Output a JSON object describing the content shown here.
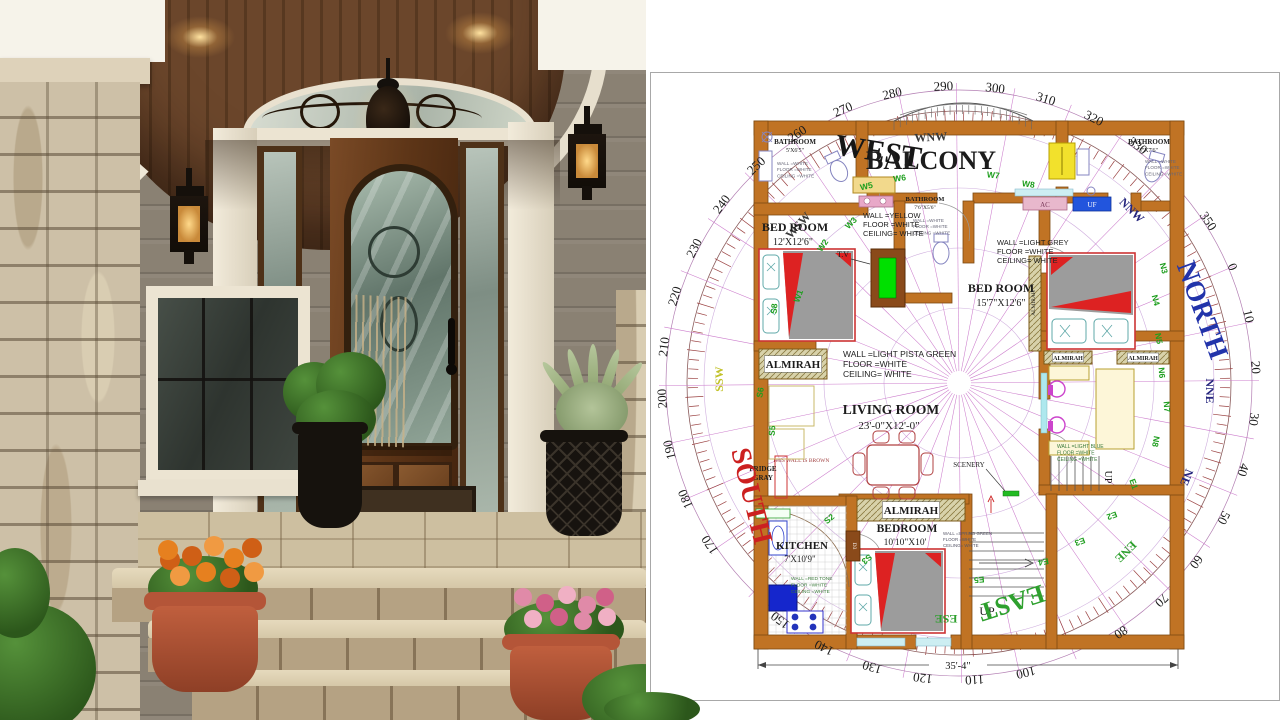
{
  "colors": {
    "wall": "#c07324",
    "wall_stroke": "#7c4a12",
    "radial": "#cc7ccc",
    "tick_ring": "#9a4040",
    "green_code": "#1e9e1e",
    "north": "#2233aa",
    "south": "#cc2020",
    "east": "#2ea02e",
    "west": "#161616"
  },
  "floor_plan": {
    "dimension_label": "35'-4\"",
    "compass": {
      "degrees": [
        0,
        10,
        20,
        30,
        40,
        50,
        60,
        70,
        80,
        100,
        110,
        120,
        130,
        140,
        150,
        170,
        180,
        190,
        200,
        210,
        220,
        230,
        240,
        250,
        260,
        270,
        280,
        290,
        300,
        310,
        320,
        330,
        350
      ],
      "cardinals": [
        {
          "label": "NORTH",
          "color": "#2233aa"
        },
        {
          "label": "EAST",
          "color": "#2ea02e"
        },
        {
          "label": "SOUTH",
          "color": "#cc2020"
        },
        {
          "label": "WEST",
          "color": "#161616"
        }
      ],
      "intercardinals": [
        {
          "label": "WSW",
          "color": "#3a3a3a"
        },
        {
          "label": "WNW",
          "color": "#3a3a3a"
        },
        {
          "label": "NNW",
          "color": "#26267e"
        },
        {
          "label": "NNE",
          "color": "#26267e"
        },
        {
          "label": "NE",
          "color": "#26267e"
        },
        {
          "label": "ENE",
          "color": "#2ea02e"
        },
        {
          "label": "ESE",
          "color": "#2ea02e"
        },
        {
          "label": "SSW",
          "color": "#c2c22a"
        }
      ]
    },
    "rooms": [
      {
        "id": "bathroom-top-left",
        "name": "BATHROOM",
        "dims": "5'X6'5\"",
        "finish": [
          "WALL =WHITE",
          "FLOOR =WHITE",
          "CEILING =WHITE"
        ]
      },
      {
        "id": "balcony",
        "name": "BALCONY",
        "dims": "",
        "finish": []
      },
      {
        "id": "bathroom-top-right",
        "name": "BATHROOM",
        "dims": "7'X7'6\"",
        "finish": [
          "WALL =WHITE",
          "FLOOR =WHITE",
          "CEILING =WHITE"
        ]
      },
      {
        "id": "bathroom-middle",
        "name": "BATHROOM",
        "dims": "7'6\"X5'6\"",
        "finish": [
          "WALL =WHITE",
          "FLOOR =WHITE",
          "CEILING =WHITE"
        ]
      },
      {
        "id": "bed-room-left",
        "name": "BED ROOM",
        "dims": "12'X12'6\"",
        "finish": [
          "WALL =YELLOW",
          "FLOOR =WHITE",
          "CEILING= WHITE"
        ]
      },
      {
        "id": "bed-room-right",
        "name": "BED ROOM",
        "dims": "15'7\"X12'6\"",
        "finish": [
          "WALL =LIGHT GREY",
          "FLOOR =WHITE",
          "CEILING= WHITE"
        ]
      },
      {
        "id": "living-room",
        "name": "LIVING ROOM",
        "dims": "23'-0\"X12'-0\"",
        "finish": [
          "WALL =LIGHT PISTA GREEN",
          "FLOOR =WHITE",
          "CEILING= WHITE"
        ]
      },
      {
        "id": "kitchen",
        "name": "KITCHEN",
        "dims": "7'X10'9\"",
        "finish": [
          "WALL =RED TONE",
          "FLOOR =WHITE",
          "CEILING =WHITE"
        ]
      },
      {
        "id": "bedroom-bottom",
        "name": "BEDROOM",
        "dims": "10'10\"X10'",
        "finish": [
          "WALL =SPRING GREEN",
          "FLOOR =WHITE",
          "CEILING= WHITE"
        ]
      },
      {
        "id": "study",
        "name": "",
        "dims": "",
        "finish": [
          "WALL =LIGHT BLUE",
          "FLOOR =WHITE",
          "CEILING =WHITE"
        ]
      }
    ],
    "labels": {
      "almirah": "ALMIRAH",
      "tv": "T.V",
      "fridge_line1": "FRIDGE",
      "fridge_line2": "GRAY",
      "wall_note": "THIS WALL IS BROWN",
      "scenery": "SCENERY",
      "up": "UP",
      "ac": "AC",
      "uf": "UF",
      "door3": "D3"
    },
    "window_codes": [
      "W1",
      "W2",
      "W3",
      "W5",
      "W6",
      "W7",
      "W8"
    ],
    "shutter_codes": [
      "S2",
      "S3",
      "S5",
      "S6",
      "S8"
    ],
    "north_codes": [
      "N3",
      "N4",
      "N5",
      "N6",
      "N7",
      "N8"
    ],
    "east_codes": [
      "E1",
      "E2",
      "E3",
      "E4",
      "E5"
    ]
  }
}
